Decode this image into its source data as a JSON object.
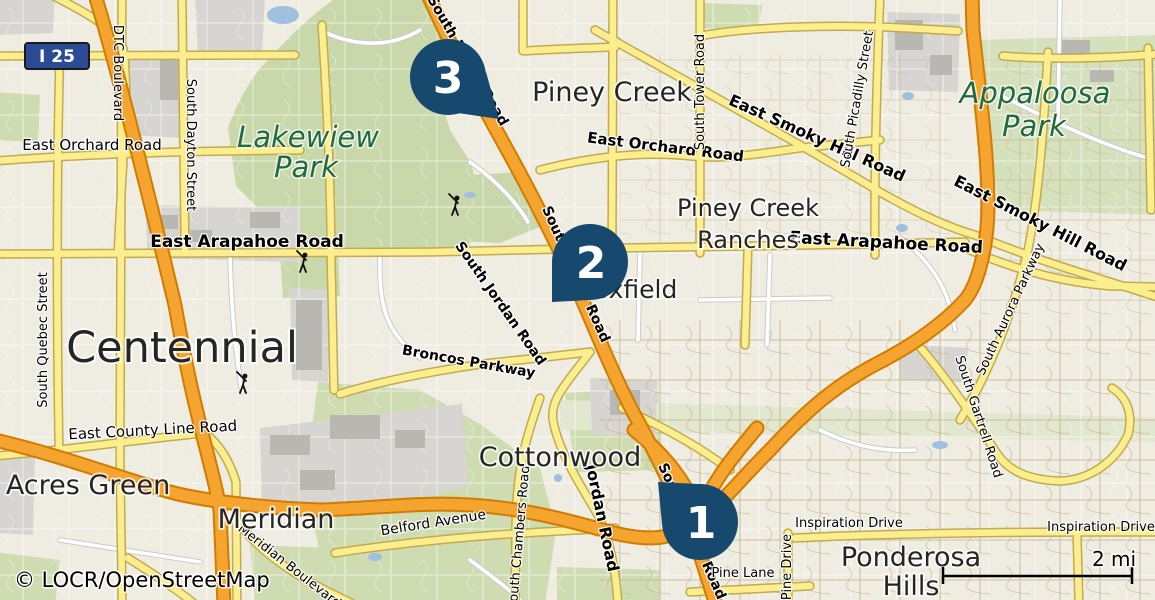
{
  "map": {
    "attribution": "© LOCR/OpenStreetMap",
    "scale_label": "2 mi",
    "shield_label": "I 25"
  },
  "colors": {
    "marker_navy": "#17496e",
    "highway_orange": "#f4a42f",
    "road_yellow": "#fcee8e",
    "park_green": "#c9d8aa",
    "park_label_green": "#216b3e",
    "shield_blue": "#2b4c95"
  },
  "markers": [
    {
      "label": "1"
    },
    {
      "label": "2"
    },
    {
      "label": "3"
    }
  ],
  "places": [
    {
      "name": "Centennial"
    },
    {
      "name": "Piney Creek"
    },
    {
      "line1": "Piney Creek",
      "line2": "Ranches"
    },
    {
      "name": "Foxfield"
    },
    {
      "name": "Cottonwood"
    },
    {
      "name": "Acres Green"
    },
    {
      "name": "Meridian"
    },
    {
      "line1": "Ponderosa",
      "line2": "Hills"
    }
  ],
  "parks": [
    {
      "line1": "Lakewiew",
      "line2": "Park"
    },
    {
      "line1": "Appaloosa",
      "line2": "Park"
    }
  ],
  "roads": [
    {
      "name": "East Orchard Road"
    },
    {
      "name": "East Orchard Road"
    },
    {
      "name": "East Arapahoe Road"
    },
    {
      "name": "East Arapahoe Road"
    },
    {
      "name": "East Smoky Hill Road"
    },
    {
      "name": "East Smoky Hill Road"
    },
    {
      "name": "DTC Boulevard"
    },
    {
      "name": "South Dayton Street"
    },
    {
      "name": "South Quebec Street"
    },
    {
      "name": "South Tower Road"
    },
    {
      "name": "South Picadilly Street"
    },
    {
      "name": "South Jordan Road"
    },
    {
      "name": "Broncos Parkway"
    },
    {
      "name": "East County Line Road"
    },
    {
      "name": "Belford Avenue"
    },
    {
      "name": "Meridian Boulevard"
    },
    {
      "name": "South Chambers Road"
    },
    {
      "name": "Jordan Road"
    },
    {
      "name": "South Parker Road"
    },
    {
      "name": "South Parker Road"
    },
    {
      "name": "South Parker Road"
    },
    {
      "name": "South Aurora Parkway"
    },
    {
      "name": "South Gartrell Road"
    },
    {
      "name": "Inspiration Drive"
    },
    {
      "name": "Inspiration Drive"
    },
    {
      "name": "Pine Lane"
    },
    {
      "name": "Pine Drive"
    }
  ]
}
